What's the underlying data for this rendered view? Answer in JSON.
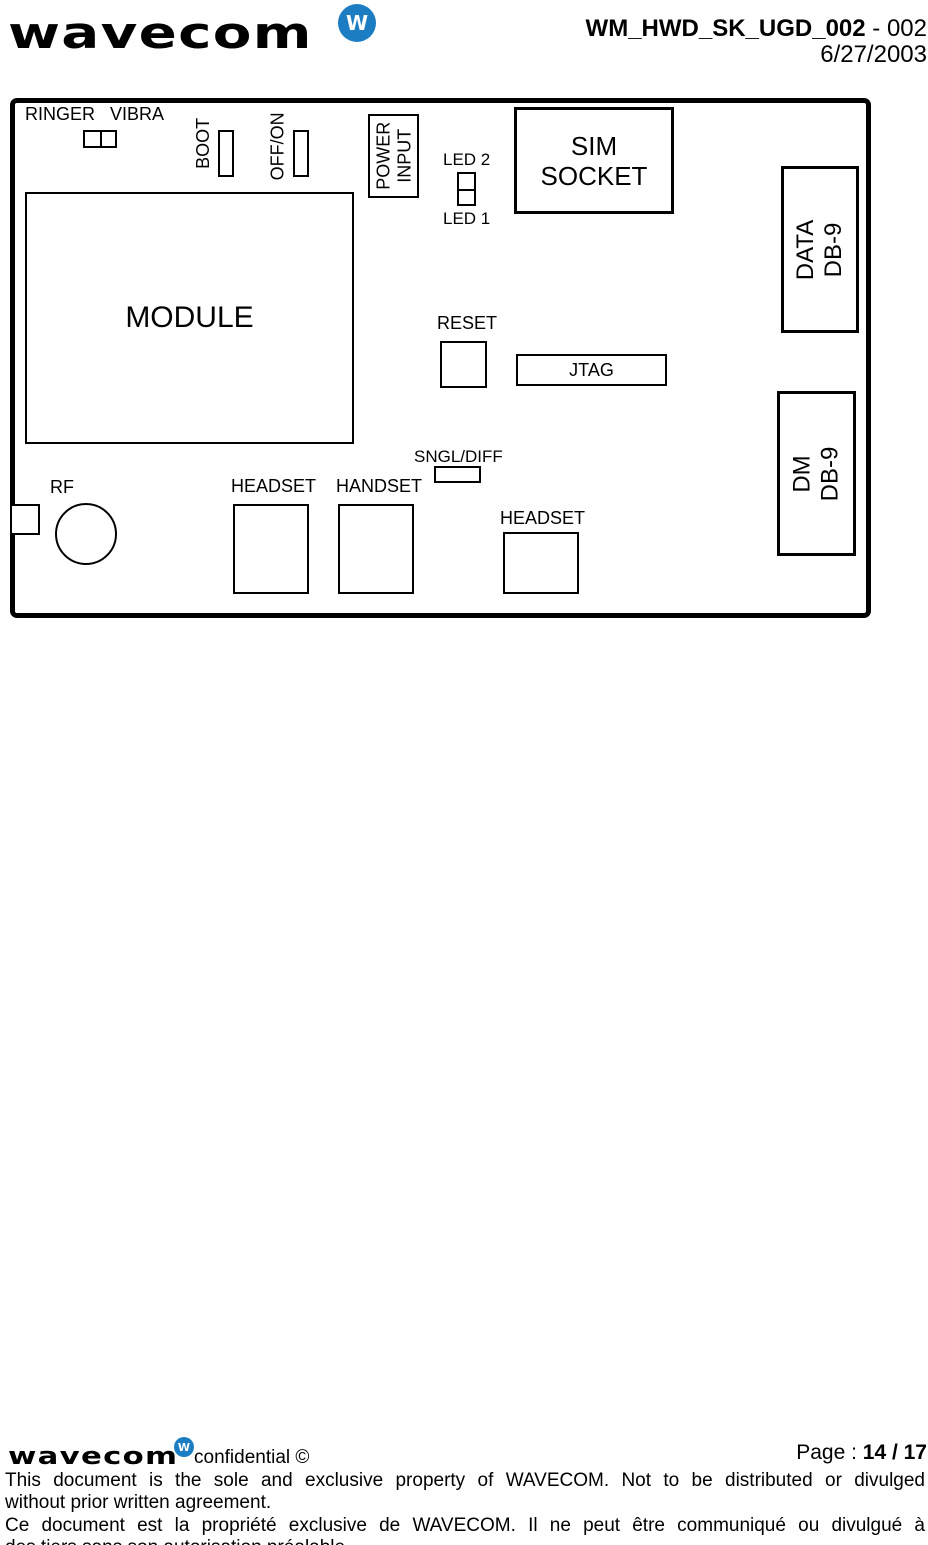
{
  "colors": {
    "brand_blue": "#1d7dc2",
    "ink": "#000000"
  },
  "header": {
    "logo_text": "wavecom",
    "badge_letter": "W",
    "doc_code": "WM_HWD_SK_UGD_002",
    "doc_code_suffix": " - 002",
    "date": "6/27/2003"
  },
  "board": {
    "ringer": "RINGER",
    "vibra": "VIBRA",
    "boot": "BOOT",
    "off_on": "OFF/ON",
    "power_line1": "POWER",
    "power_line2": "INPUT",
    "led2": "LED 2",
    "led1": "LED 1",
    "sim_line1": "SIM",
    "sim_line2": "SOCKET",
    "module": "MODULE",
    "data_db9_line1": "DATA",
    "data_db9_line2": "DB-9",
    "reset": "RESET",
    "jtag": "JTAG",
    "dm_db9_line1": "DM",
    "dm_db9_line2": "DB-9",
    "sngl_diff": "SNGL/DIFF",
    "rf": "RF",
    "headset_left": "HEADSET",
    "handset": "HANDSET",
    "headset_bottom": "HEADSET"
  },
  "footer": {
    "logo_text": "wavecom",
    "badge_letter": "W",
    "confidential": "confidential ©",
    "page_label": "Page : ",
    "page_value": "14 / 17",
    "en_line1": "This document is the sole and exclusive property of WAVECOM. Not to be distributed or divulged",
    "en_line2": "without prior written agreement.",
    "fr_line1": "Ce document est la propriété exclusive de WAVECOM. Il ne peut être communiqué ou divulgué à",
    "fr_line2": "des tiers sans son autorisation préalable."
  }
}
